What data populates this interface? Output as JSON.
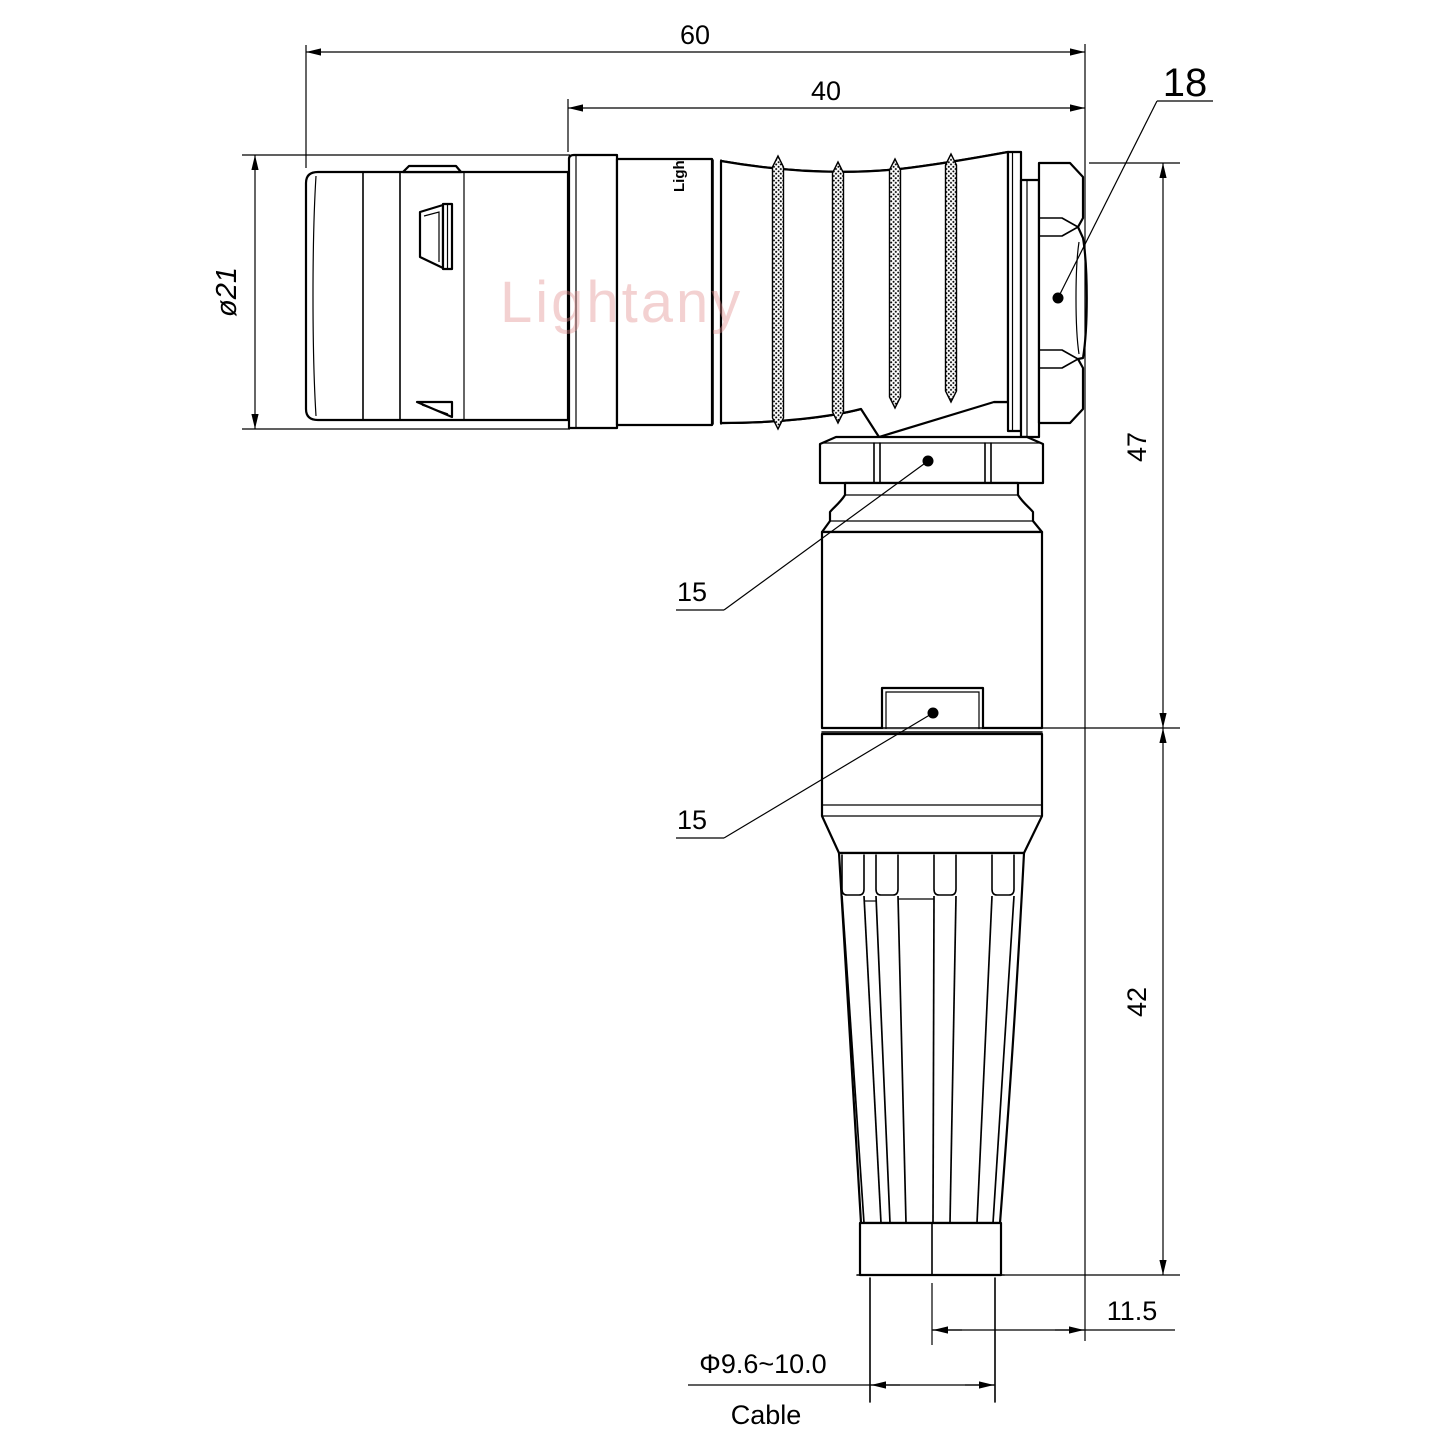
{
  "drawing": {
    "watermark": "Lightany",
    "body_logo": "Lightany",
    "dims": {
      "overall_length": "60",
      "rear_length": "40",
      "nut_size": "18",
      "shell_dia": "ø21",
      "upper_height": "47",
      "lower_height": "42",
      "exit_offset": "11.5",
      "cable_dia": "Φ9.6~10.0",
      "cable_word": "Cable",
      "backnut_width": "15",
      "clamp_width": "15"
    },
    "colors": {
      "line": "#000000",
      "watermark": "#e38f8f",
      "background": "#ffffff"
    }
  }
}
